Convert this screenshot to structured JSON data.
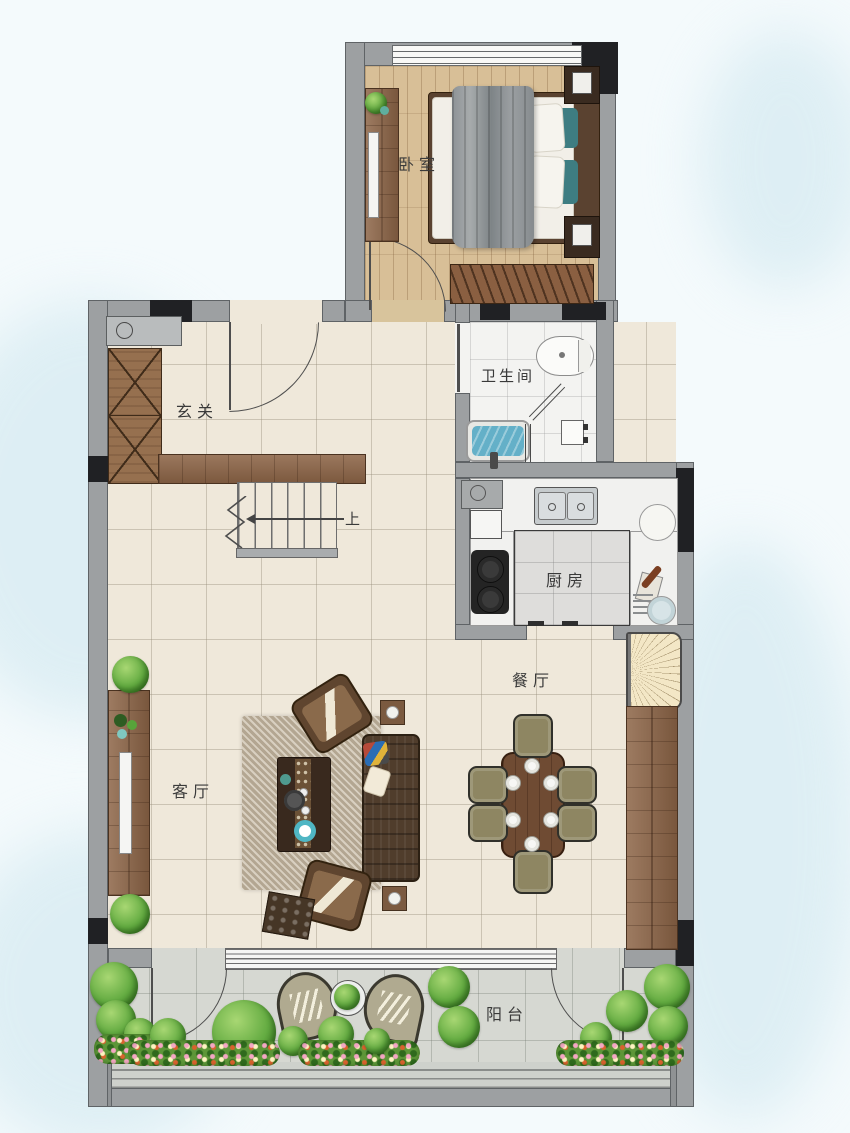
{
  "rooms": {
    "bedroom": {
      "label": "卧室"
    },
    "bathroom": {
      "label": "卫生间"
    },
    "entry": {
      "label": "玄关"
    },
    "kitchen": {
      "label": "厨房"
    },
    "dining": {
      "label": "餐厅"
    },
    "living": {
      "label": "客厅"
    },
    "balcony": {
      "label": "阳台"
    }
  },
  "stairs": {
    "up_label": "上"
  },
  "colors": {
    "wall": "#9da0a2",
    "column": "#202124",
    "tile_floor": "#efe8da",
    "wood_floor": "#d8bf97",
    "marble_floor": "#f3f3f1",
    "balcony_floor": "#d6d8d2",
    "furniture_wood": "#8d6547",
    "sofa": "#503d2c",
    "bath_water": "#64b0c8",
    "plant": "#63ab41",
    "background": "#f4fafc"
  }
}
